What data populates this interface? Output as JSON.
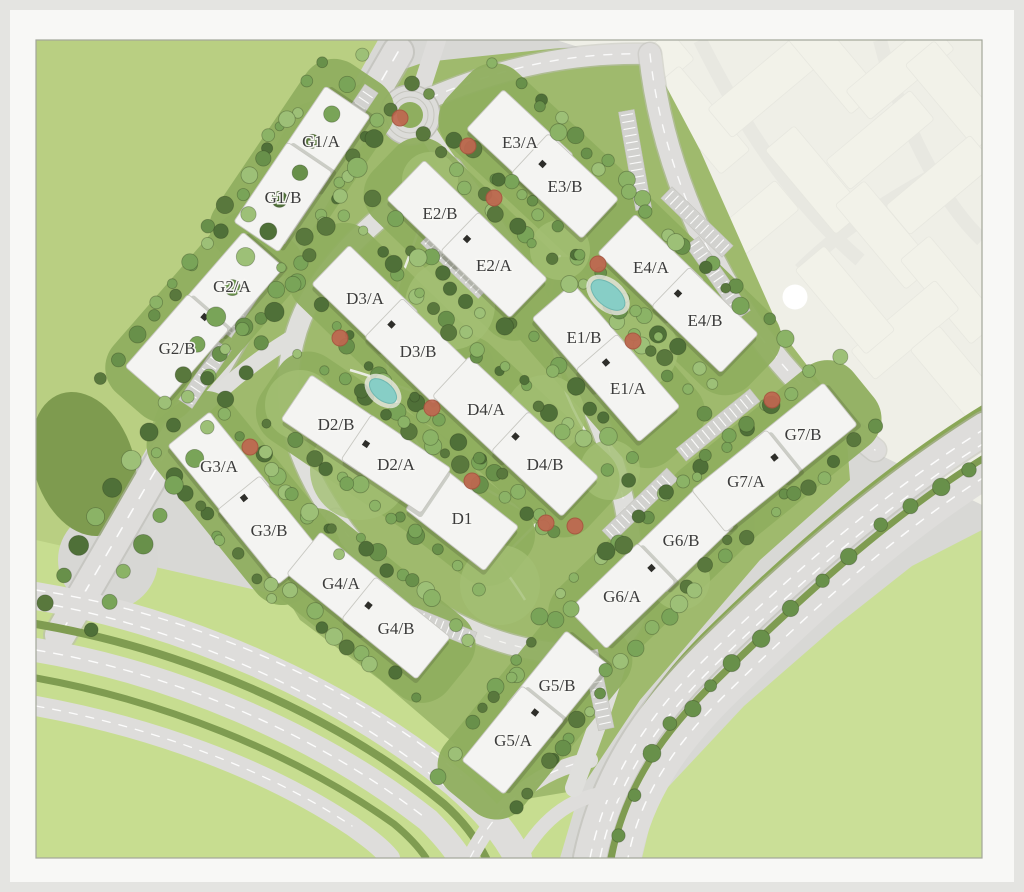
{
  "map": {
    "kind": "residential-master-site-plan",
    "buildings": [
      {
        "label": "G1/A",
        "x": 321,
        "y": 141,
        "rot": -56
      },
      {
        "label": "G1/B",
        "x": 283,
        "y": 197,
        "rot": -56
      },
      {
        "label": "G2/A",
        "x": 232,
        "y": 286,
        "rot": -49
      },
      {
        "label": "G2/B",
        "x": 177,
        "y": 348,
        "rot": -49
      },
      {
        "label": "G3/A",
        "x": 219,
        "y": 466,
        "rot": 51
      },
      {
        "label": "G3/B",
        "x": 269,
        "y": 530,
        "rot": 51
      },
      {
        "label": "G4/A",
        "x": 341,
        "y": 583,
        "rot": 39
      },
      {
        "label": "G4/B",
        "x": 396,
        "y": 628,
        "rot": 39
      },
      {
        "label": "G5/B",
        "x": 557,
        "y": 685,
        "rot": -51
      },
      {
        "label": "G5/A",
        "x": 513,
        "y": 740,
        "rot": -51
      },
      {
        "label": "G6/B",
        "x": 681,
        "y": 540,
        "rot": -44
      },
      {
        "label": "G6/A",
        "x": 622,
        "y": 596,
        "rot": -44
      },
      {
        "label": "G7/B",
        "x": 803,
        "y": 434,
        "rot": -39
      },
      {
        "label": "G7/A",
        "x": 746,
        "y": 481,
        "rot": -39
      },
      {
        "label": "D1",
        "x": 462,
        "y": 518,
        "rot": 38
      },
      {
        "label": "D2/B",
        "x": 336,
        "y": 424,
        "rot": 34
      },
      {
        "label": "D2/A",
        "x": 396,
        "y": 464,
        "rot": 34
      },
      {
        "label": "D3/A",
        "x": 365,
        "y": 298,
        "rot": 44
      },
      {
        "label": "D3/B",
        "x": 418,
        "y": 351,
        "rot": 44
      },
      {
        "label": "D4/A",
        "x": 486,
        "y": 409,
        "rot": 43
      },
      {
        "label": "D4/B",
        "x": 545,
        "y": 464,
        "rot": 43
      },
      {
        "label": "E1/B",
        "x": 584,
        "y": 337,
        "rot": 49
      },
      {
        "label": "E1/A",
        "x": 628,
        "y": 388,
        "rot": 49
      },
      {
        "label": "E2/B",
        "x": 440,
        "y": 213,
        "rot": 44
      },
      {
        "label": "E2/A",
        "x": 494,
        "y": 265,
        "rot": 44
      },
      {
        "label": "E3/A",
        "x": 520,
        "y": 142,
        "rot": 43
      },
      {
        "label": "E3/B",
        "x": 565,
        "y": 186,
        "rot": 43
      },
      {
        "label": "E4/A",
        "x": 651,
        "y": 267,
        "rot": 44
      },
      {
        "label": "E4/B",
        "x": 705,
        "y": 320,
        "rot": 44
      }
    ],
    "marker": {
      "x": 795,
      "y": 297
    },
    "roundabout": {
      "x": 410,
      "y": 115
    },
    "pools": [
      {
        "x": 383,
        "y": 391,
        "rx": 16,
        "ry": 9,
        "rot": 40
      },
      {
        "x": 608,
        "y": 295,
        "rx": 20,
        "ry": 11,
        "rot": 40
      }
    ],
    "red_trees": [
      [
        400,
        118
      ],
      [
        468,
        146
      ],
      [
        494,
        198
      ],
      [
        340,
        338
      ],
      [
        432,
        408
      ],
      [
        472,
        481
      ],
      [
        546,
        523
      ],
      [
        598,
        264
      ],
      [
        633,
        341
      ],
      [
        250,
        447
      ],
      [
        772,
        400
      ],
      [
        575,
        526
      ]
    ],
    "palette": {
      "park_light": "#b9cf82",
      "park_bright": "#c7dd90",
      "park_se": "#cadf97",
      "compound_green": "#9fba6d",
      "ribbon_green": "#8fae5f",
      "dark_green": "#7e9b4f",
      "median_green": "#7f9c51",
      "road": "#dedddb",
      "paved": "#d8d8d5",
      "building": "#f4f4f2",
      "core": "#2e2e2a",
      "red_tree": "#bf6750",
      "pool": "#87cec6",
      "label": "#3c3c3c",
      "faded_zone": "#e4e4d8",
      "mat": "#f8f8f6"
    }
  }
}
